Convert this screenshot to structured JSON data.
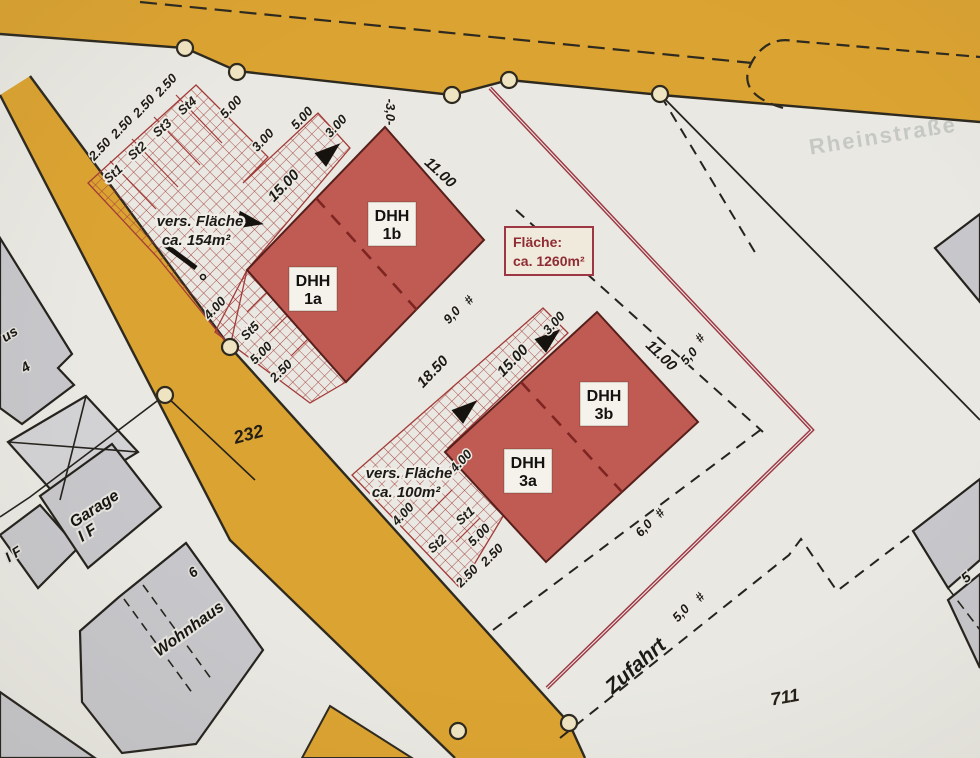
{
  "plan": {
    "street_name_faint": "Rheinstraße",
    "area_box": {
      "line1": "Fläche:",
      "line2": "ca. 1260m²"
    },
    "buildings": [
      {
        "id": "dhh-1a",
        "line1": "DHH",
        "line2": "1a"
      },
      {
        "id": "dhh-1b",
        "line1": "DHH",
        "line2": "1b"
      },
      {
        "id": "dhh-3a",
        "line1": "DHH",
        "line2": "3a"
      },
      {
        "id": "dhh-3b",
        "line1": "DHH",
        "line2": "3b"
      }
    ],
    "colors": {
      "paper": "#e9e8e2",
      "road_yellow": "#dba331",
      "road_edge": "#2e2a20",
      "building_red": "#bf5b53",
      "building_red_edge": "#571f1b",
      "hatch_red": "#a33b38",
      "boundary_red": "#9e3744",
      "neighbor_gray": "#c7c7cb"
    },
    "annotations": [
      [
        "2.50",
        103,
        152,
        -47,
        "t-dim"
      ],
      [
        "2.50",
        125,
        130,
        -47,
        "t-dim"
      ],
      [
        "2.50",
        147,
        109,
        -47,
        "t-dim"
      ],
      [
        "2.50",
        169,
        88,
        -47,
        "t-dim"
      ],
      [
        "5.00",
        234,
        110,
        -47,
        "t-dim"
      ],
      [
        "3.00",
        266,
        143,
        -47,
        "t-dim"
      ],
      [
        "5.00",
        305,
        121,
        -47,
        "t-dim"
      ],
      [
        "3.00",
        339,
        129,
        -47,
        "t-dim"
      ],
      [
        "15.00",
        287,
        189,
        -46,
        "t-dim-lg"
      ],
      [
        "11.00",
        437,
        176,
        43,
        "t-dim-lg"
      ],
      [
        "-3,0-",
        386,
        112,
        90,
        "t-dim"
      ],
      [
        "St1",
        116,
        177,
        -42,
        "t-st"
      ],
      [
        "St2",
        140,
        154,
        -42,
        "t-st"
      ],
      [
        "St3",
        165,
        131,
        -42,
        "t-st"
      ],
      [
        "St4",
        190,
        109,
        -42,
        "t-st"
      ],
      [
        "vers. Fläche",
        200,
        226,
        0,
        "t-vers"
      ],
      [
        "ca. 154m²",
        196,
        245,
        0,
        "t-vers"
      ],
      [
        "4.00",
        218,
        311,
        -47,
        "t-dim"
      ],
      [
        "St5",
        253,
        334,
        -45,
        "t-st"
      ],
      [
        "5.00",
        264,
        356,
        -45,
        "t-dim"
      ],
      [
        "2.50",
        284,
        374,
        -45,
        "t-dim"
      ],
      [
        "232",
        250,
        440,
        -15,
        "t-road"
      ],
      [
        "us",
        12,
        338,
        -33,
        "t-name-sm"
      ],
      [
        "4",
        28,
        371,
        -33,
        "t-name-sm"
      ],
      [
        "Garage",
        97,
        513,
        -33,
        "t-name"
      ],
      [
        "I F",
        90,
        537,
        -33,
        "t-name"
      ],
      [
        "I F",
        16,
        558,
        -33,
        "t-name-sm"
      ],
      [
        "6",
        196,
        576,
        -38,
        "t-name-sm"
      ],
      [
        "Wohnhaus",
        192,
        633,
        -36,
        "t-name"
      ],
      [
        "9,0",
        455,
        318,
        -47,
        "t-dim"
      ],
      [
        "#",
        472,
        303,
        -47,
        "t-dim"
      ],
      [
        "3.00",
        557,
        326,
        -47,
        "t-dim"
      ],
      [
        "15.00",
        516,
        364,
        -46,
        "t-dim-lg"
      ],
      [
        "18.50",
        436,
        375,
        -46,
        "t-dim-lg"
      ],
      [
        "11.00",
        658,
        359,
        44,
        "t-dim-lg"
      ],
      [
        "#",
        703,
        341,
        -47,
        "t-dim"
      ],
      [
        "5,0",
        692,
        359,
        -47,
        "t-dim"
      ],
      [
        "4.00",
        464,
        464,
        -47,
        "t-dim"
      ],
      [
        "vers. Fläche",
        409,
        478,
        0,
        "t-vers"
      ],
      [
        "ca. 100m²",
        406,
        497,
        0,
        "t-vers"
      ],
      [
        "4.00",
        406,
        517,
        -47,
        "t-dim"
      ],
      [
        "St1",
        468,
        519,
        -42,
        "t-st"
      ],
      [
        "St2",
        440,
        547,
        -42,
        "t-st"
      ],
      [
        "5.00",
        482,
        538,
        -45,
        "t-dim"
      ],
      [
        "2.50",
        495,
        558,
        -45,
        "t-dim"
      ],
      [
        "2.50",
        470,
        579,
        -45,
        "t-dim"
      ],
      [
        "#",
        663,
        516,
        -47,
        "t-dim"
      ],
      [
        "6,0",
        647,
        531,
        -47,
        "t-dim"
      ],
      [
        "#",
        703,
        600,
        -47,
        "t-dim"
      ],
      [
        "5,0",
        684,
        616,
        -47,
        "t-dim"
      ],
      [
        "Zufahrt",
        640,
        671,
        -41,
        "t-zufahrt"
      ],
      [
        "711",
        786,
        703,
        -10,
        "t-road"
      ],
      [
        "Rheinstraße",
        884,
        143,
        -9,
        "t-faint"
      ],
      [
        "5",
        969,
        581,
        -40,
        "t-name-sm"
      ]
    ],
    "boundary_circles": [
      [
        185,
        48
      ],
      [
        237,
        72
      ],
      [
        452,
        95
      ],
      [
        509,
        80
      ],
      [
        660,
        94
      ],
      [
        230,
        347
      ],
      [
        165,
        395
      ],
      [
        458,
        731
      ],
      [
        569,
        723
      ]
    ],
    "entrance_triangles": [
      [
        252,
        222,
        10
      ],
      [
        331,
        151,
        -40
      ],
      [
        468,
        408,
        -40
      ],
      [
        551,
        337,
        -40
      ]
    ]
  }
}
